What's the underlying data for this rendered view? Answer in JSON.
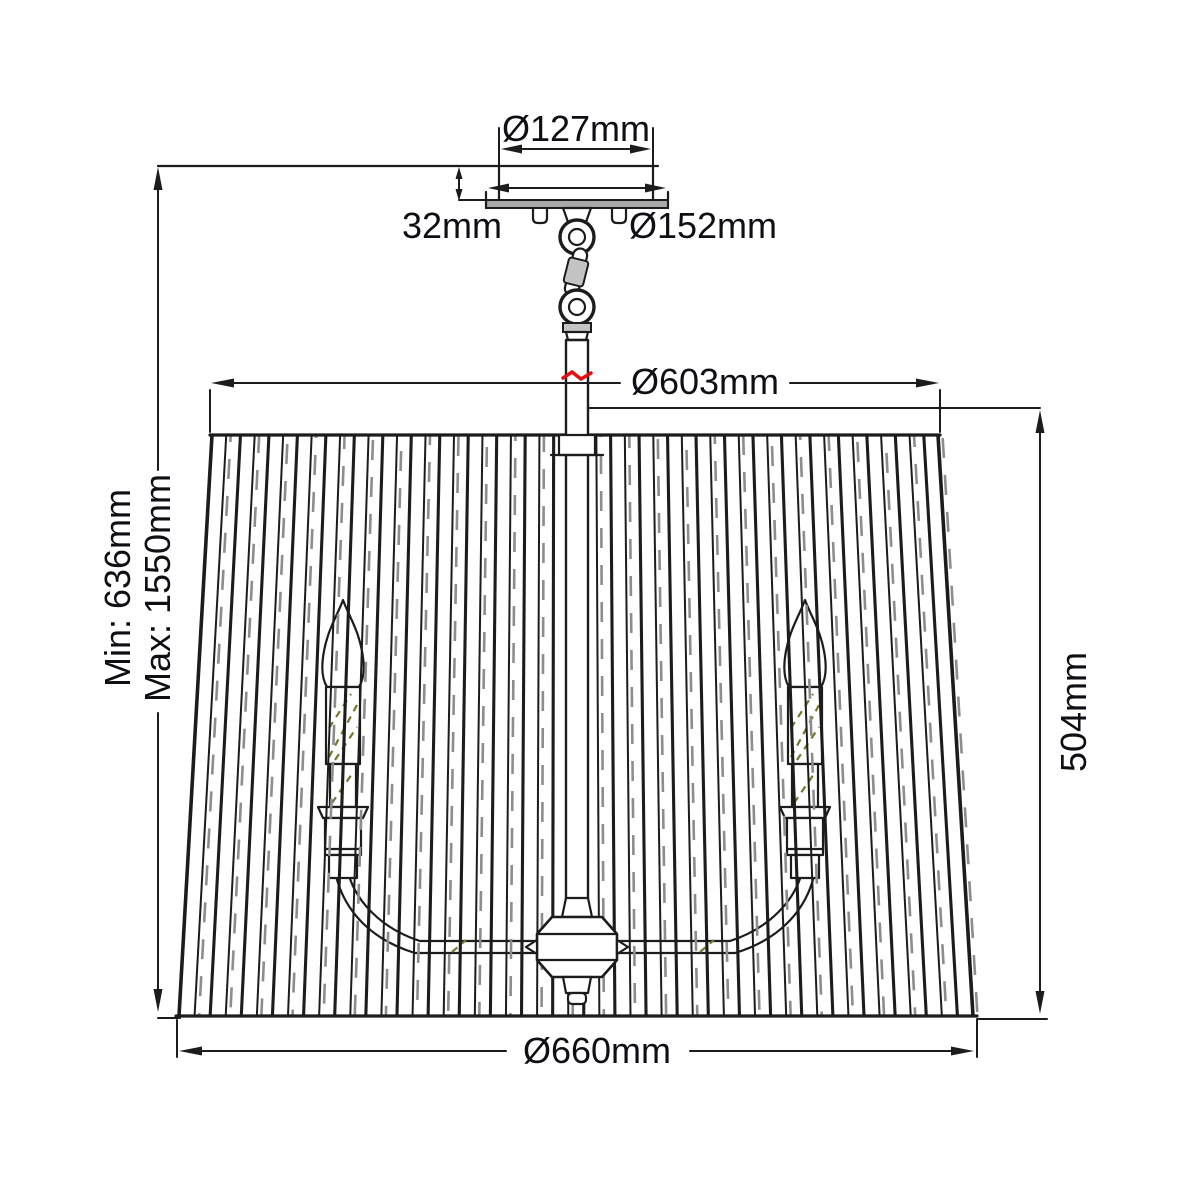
{
  "title": "Pendant light fixture dimension diagram",
  "colors": {
    "line": "#1c1c1c",
    "text": "#0e0e14",
    "plate": "#a8a8a8",
    "metal": "#c4c4c4",
    "slat_gray": "#8d8d8d",
    "hatch": "#76762c",
    "red": "#e01010",
    "bg": "#ffffff"
  },
  "dimensions": {
    "canopy_diameter": "Ø127mm",
    "canopy_height": "32mm",
    "plate_diameter": "Ø152mm",
    "shade_top_diameter": "Ø603mm",
    "drop_min": "Min: 636mm",
    "drop_max": "Max: 1550mm",
    "shade_height": "504mm",
    "shade_bottom_diameter": "Ø660mm"
  }
}
